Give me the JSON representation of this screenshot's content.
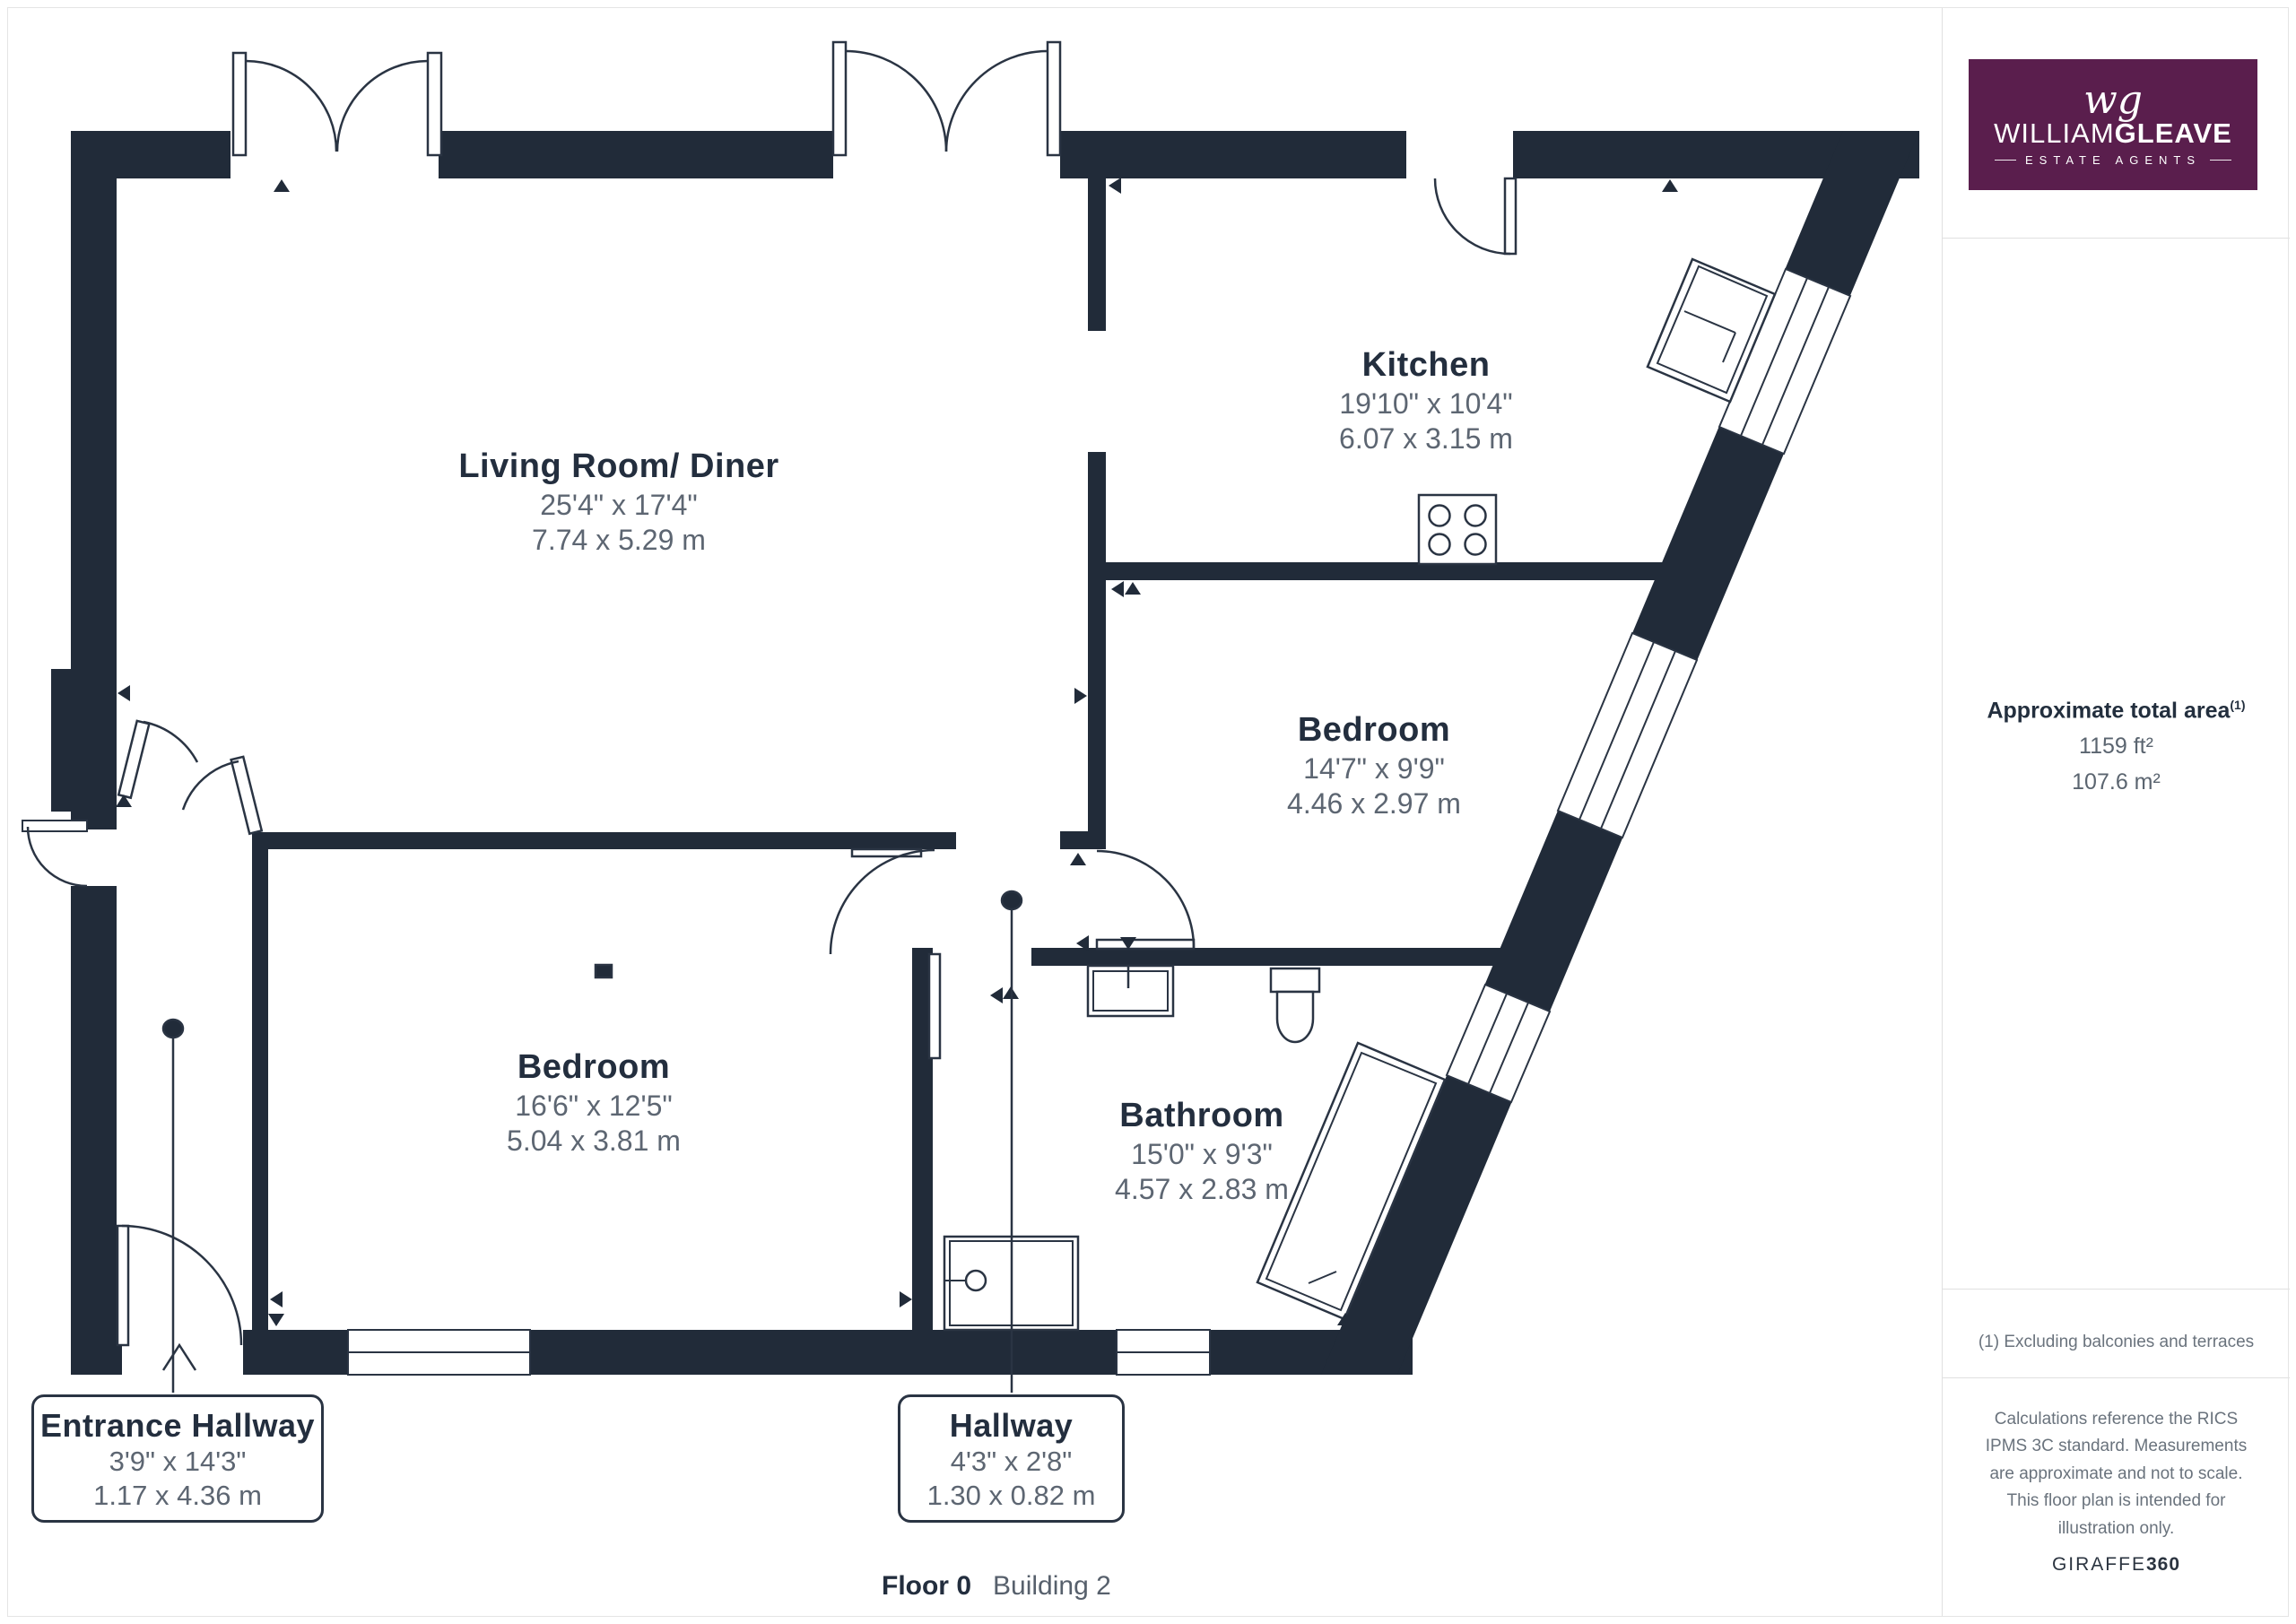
{
  "colors": {
    "wall": "#212b39",
    "room_name_text": "#232e3e",
    "dims_text": "#5d6672",
    "logo_background": "#5a1e4d",
    "divider": "#e0e0e0"
  },
  "brand": {
    "monogram": "wg",
    "name_part1": "WILLIAM",
    "name_part2": "GLEAVE",
    "tagline": "ESTATE AGENTS"
  },
  "rooms": [
    {
      "name": "Living Room/ Diner",
      "imperial": "25'4\" x 17'4\"",
      "metric": "7.74 x 5.29 m"
    },
    {
      "name": "Kitchen",
      "imperial": "19'10\" x 10'4\"",
      "metric": "6.07 x 3.15 m"
    },
    {
      "name": "Bedroom",
      "imperial": "14'7\" x 9'9\"",
      "metric": "4.46 x 2.97 m"
    },
    {
      "name": "Bedroom",
      "imperial": "16'6\" x 12'5\"",
      "metric": "5.04 x 3.81 m"
    },
    {
      "name": "Bathroom",
      "imperial": "15'0\" x 9'3\"",
      "metric": "4.57 x 2.83 m"
    }
  ],
  "callouts": [
    {
      "name": "Entrance Hallway",
      "imperial": "3'9\" x 14'3\"",
      "metric": "1.17 x 4.36 m"
    },
    {
      "name": "Hallway",
      "imperial": "4'3\" x 2'8\"",
      "metric": "1.30 x 0.82 m"
    }
  ],
  "footer": {
    "floor": "Floor 0",
    "building": "Building 2"
  },
  "sidebar": {
    "total_area_label": "Approximate total area",
    "total_area_sup": "(1)",
    "area_ft": "1159 ft²",
    "area_m": "107.6 m²",
    "footnote": "(1) Excluding balconies and terraces",
    "disclaimer": "Calculations reference the RICS IPMS 3C standard. Measurements are approximate and not to scale. This floor plan is intended for illustration only.",
    "giraffe_part1": "GIRAFFE",
    "giraffe_part2": "360"
  }
}
